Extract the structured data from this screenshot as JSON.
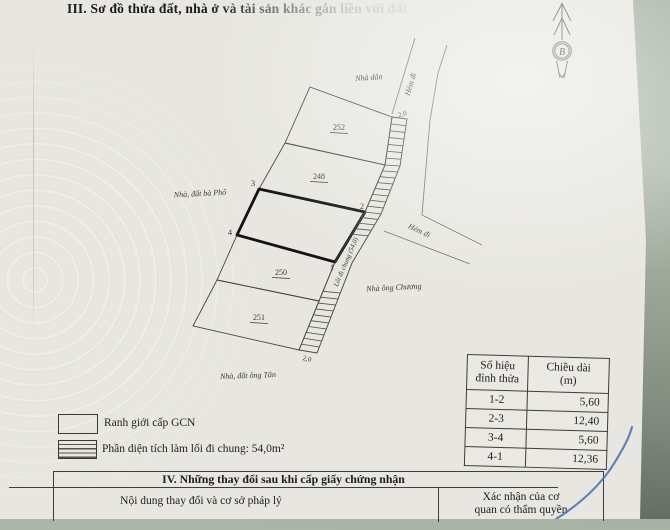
{
  "page": {
    "section3_title": "III. Sơ đồ thửa đất, nhà ở và tài sản khác gắn liền với đất"
  },
  "compass": {
    "north_label": "B"
  },
  "diagram": {
    "labels": {
      "nha_dan": "Nhà dân",
      "hem_di_top": "Hẻm đi",
      "hem_di_right": "Hẻm đi",
      "width_top": "2,0",
      "width_bottom": "2,0",
      "plot_252": "252",
      "plot_248": "248",
      "plot_250": "250",
      "plot_251": "251",
      "corner_1": "1",
      "corner_2": "2",
      "corner_3": "3",
      "corner_4": "4",
      "loi_di_chung": "Lối đi chung (54,0)",
      "nha_ong_chuong": "Nhà ông Chương",
      "nha_dat_ba_pho": "Nhà, đất bà Phố",
      "nha_dat_ong_tan": "Nhà, đất ông Tân"
    }
  },
  "legend": {
    "items": [
      {
        "label": "Ranh giới cấp GCN"
      },
      {
        "label": "Phần diện tích làm lối đi chung: 54,0m²"
      }
    ]
  },
  "dimension_table": {
    "header_col1_line1": "Số hiệu",
    "header_col1_line2": "đỉnh thửa",
    "header_col2_line1": "Chiều dài",
    "header_col2_line2": "(m)",
    "rows": [
      {
        "edge": "1-2",
        "length": "5,60"
      },
      {
        "edge": "2-3",
        "length": "12,40"
      },
      {
        "edge": "3-4",
        "length": "5,60"
      },
      {
        "edge": "4-1",
        "length": "12,36"
      }
    ]
  },
  "section4": {
    "title": "IV. Những thay đổi sau khi cấp giấy chứng nhận",
    "col_left": "Nội dung thay đổi và cơ sở pháp lý",
    "col_right_line1": "Xác nhận của cơ",
    "col_right_line2": "quan có thẩm quyền"
  }
}
